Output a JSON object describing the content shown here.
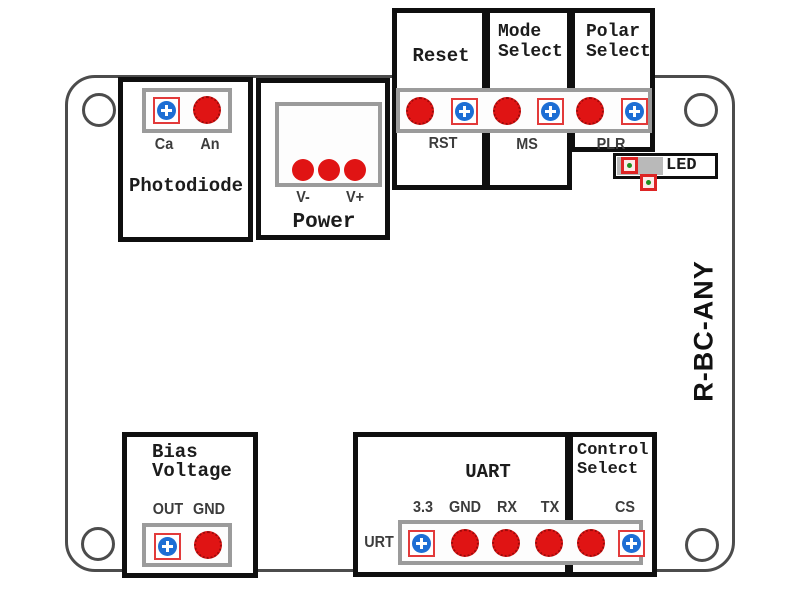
{
  "board": {
    "model_label": "R-BC-ANY",
    "colors": {
      "terminal_red": "#e01414",
      "terminal_blue": "#1d6ed4",
      "pad_outline_red": "#e23a3a",
      "strip_gray": "#9b9b9b",
      "board_outline": "#4c4c4c",
      "box_border": "#0f0f0f",
      "led_dot_green": "#1e8f1e"
    }
  },
  "sections": {
    "photodiode": {
      "title": "Photodiode",
      "pin_left": "Ca",
      "pin_right": "An"
    },
    "power": {
      "title": "Power",
      "pin_left": "V-",
      "pin_right": "V+"
    },
    "reset": {
      "title": "Reset",
      "pin_label": "RST"
    },
    "mode_select": {
      "title_line1": "Mode",
      "title_line2": "Select",
      "pin_label": "MS"
    },
    "polar_select": {
      "title_line1": "Polar",
      "title_line2": "Select",
      "pin_label": "PLR"
    },
    "led": {
      "label": "LED"
    },
    "bias_voltage": {
      "title_line1": "Bias",
      "title_line2": "Voltage",
      "pin_left": "OUT",
      "pin_right": "GND"
    },
    "uart": {
      "title": "UART",
      "connector_label": "URT",
      "pins": [
        "3.3",
        "GND",
        "RX",
        "TX"
      ]
    },
    "control_select": {
      "title_line1": "Control",
      "title_line2": "Select",
      "pin_label": "CS"
    }
  }
}
